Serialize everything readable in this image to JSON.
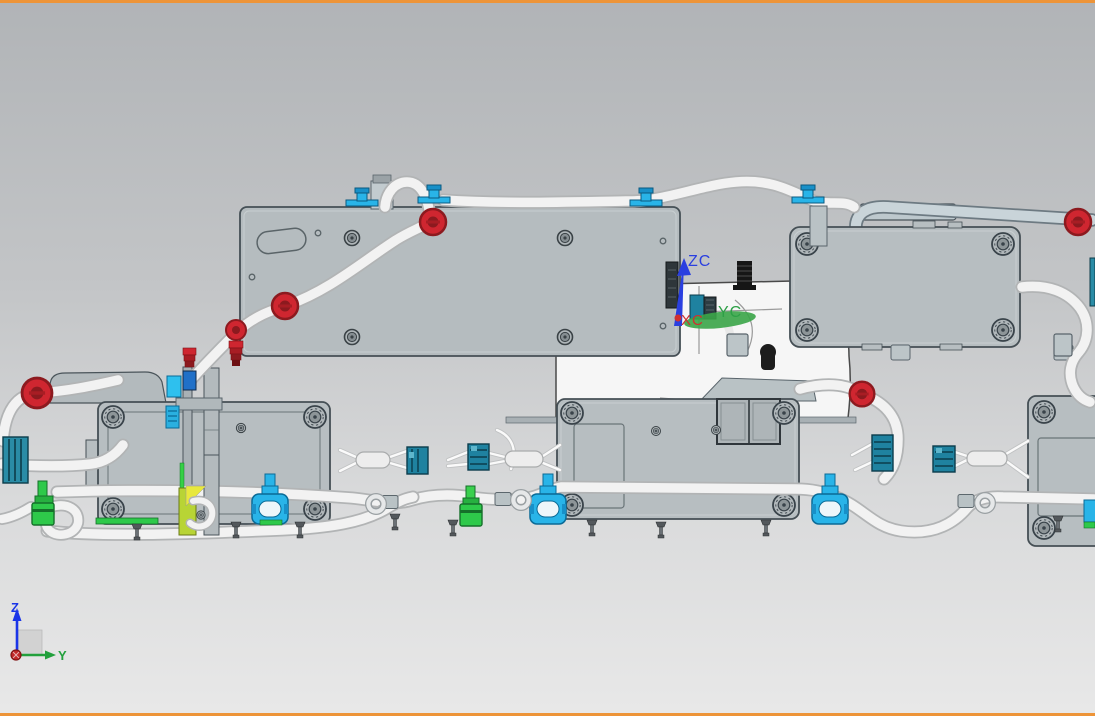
{
  "viewport": {
    "background_top": "#b2b5b8",
    "background_bottom": "#e8e8e8",
    "border_color": "#ed9438"
  },
  "wcs_triad": {
    "zc_label": "ZC",
    "yc_label": "YC",
    "xc_label": "XC",
    "zc_color": "#2a3fe0",
    "yc_color": "#2da046",
    "xc_color": "#d03030"
  },
  "view_triad": {
    "z_label": "Z",
    "y_label": "Y",
    "z_color": "#1a35e8",
    "y_color": "#22a03c",
    "origin_color": "#c02828"
  },
  "part_colors": {
    "module_gray": "#b7bec1",
    "tube_white": "#f2f2f2",
    "conduit_gray": "#c9d4d9",
    "grommet_red": "#cf2630",
    "clip_cyan": "#29b4e8",
    "connector_teal": "#1f82a0",
    "connector_green": "#2ec94a",
    "highlight_yellow": "#e8e83d",
    "highlight_yellow_green": "#b8d435",
    "stud_black": "#161616"
  }
}
